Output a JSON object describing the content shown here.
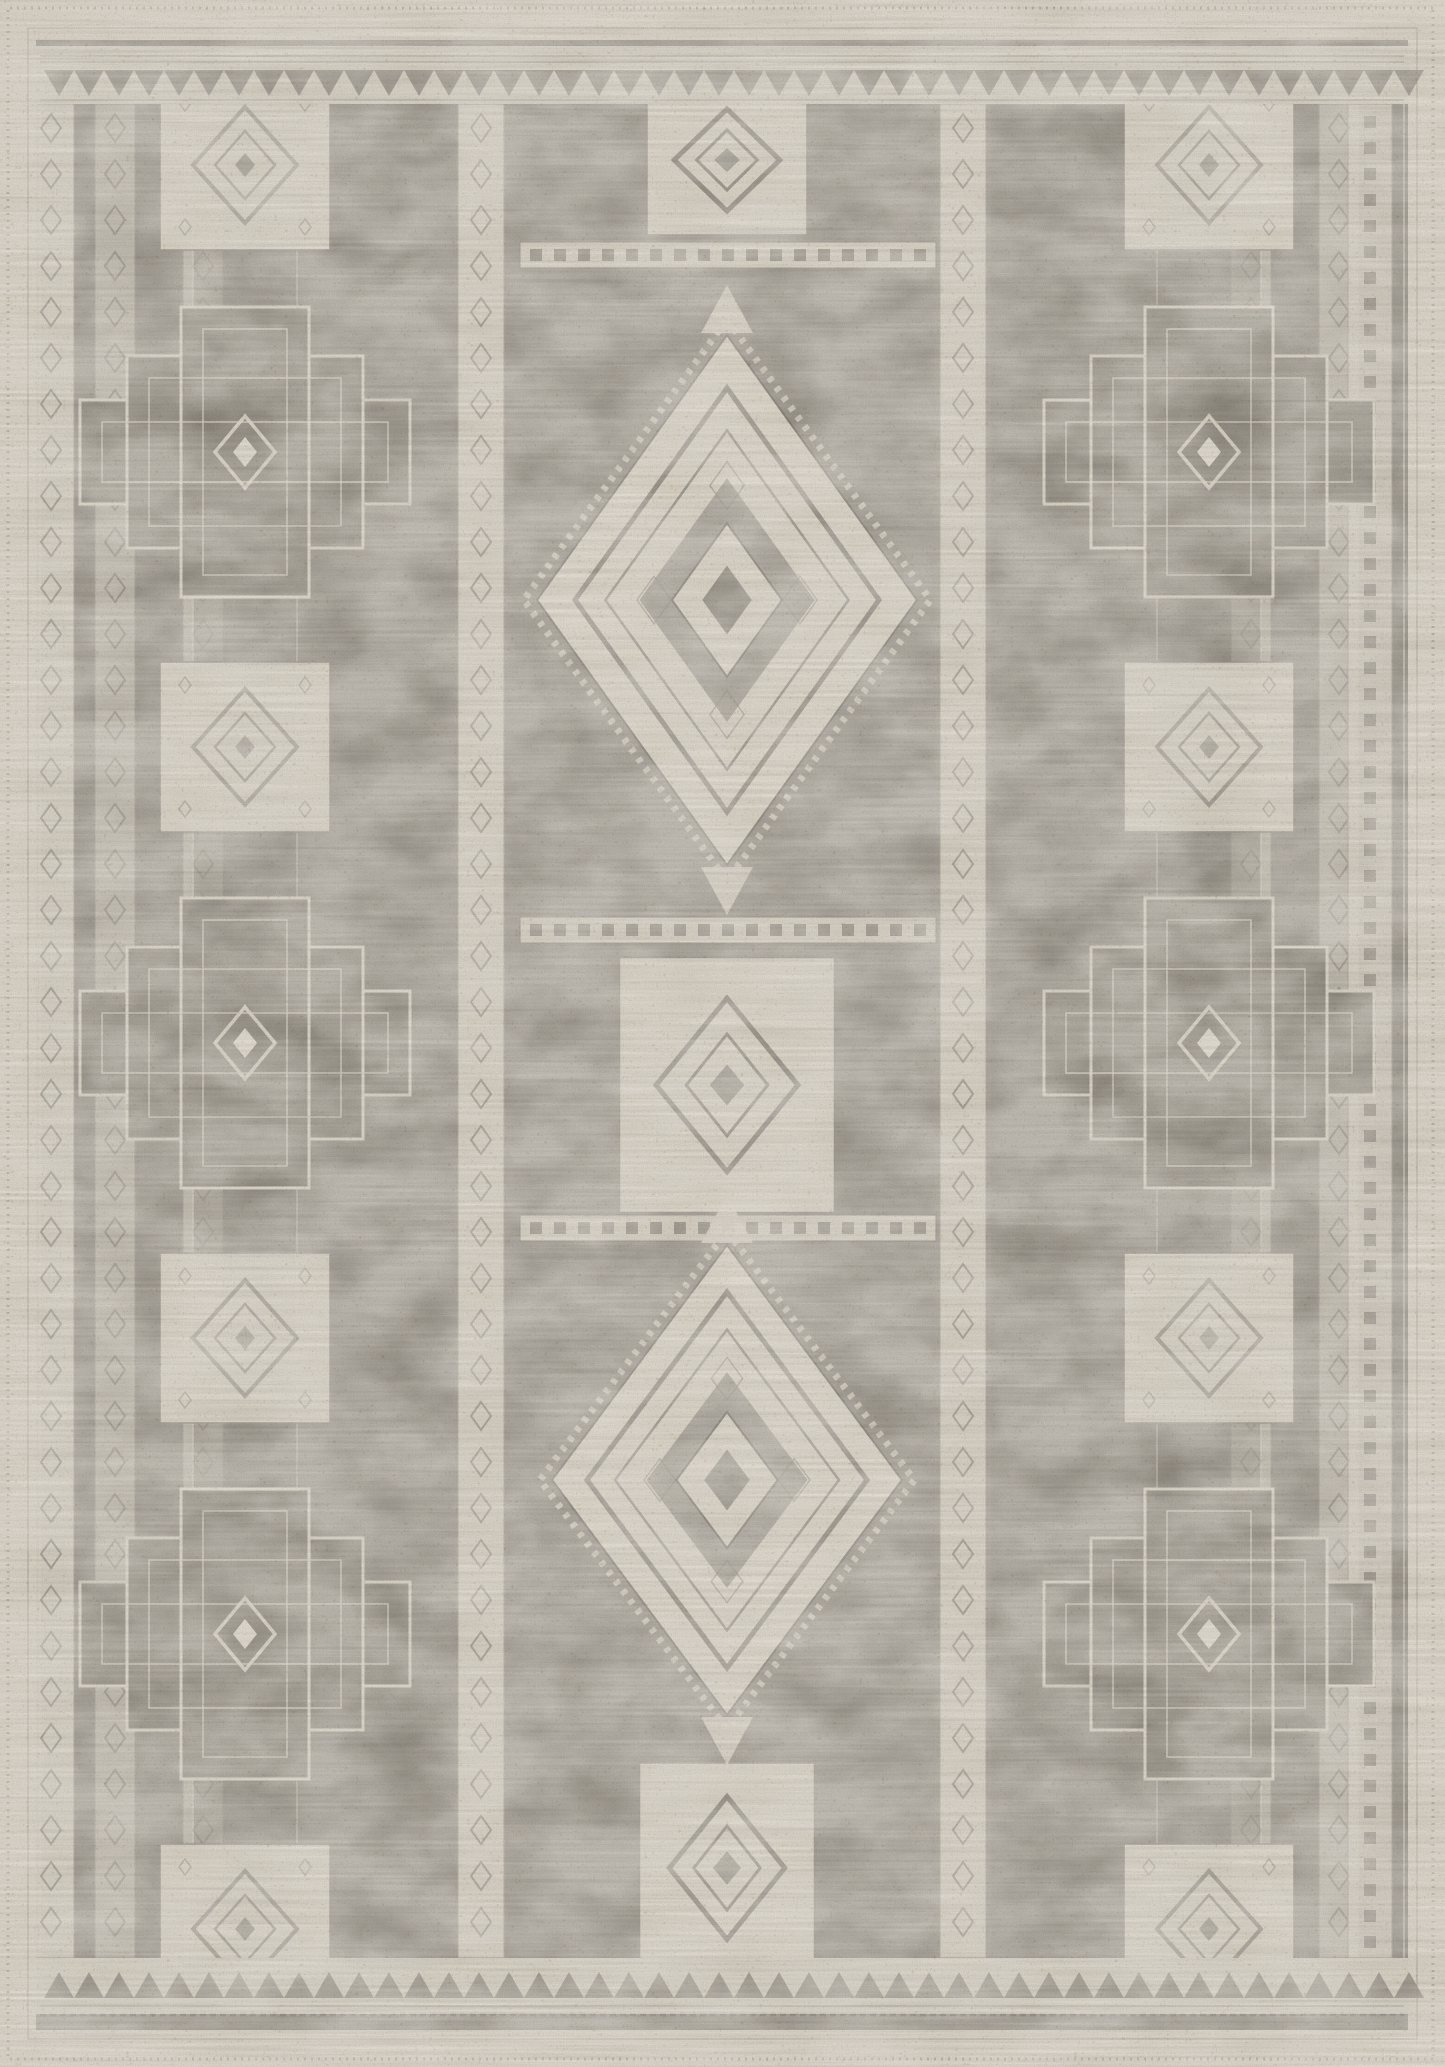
{
  "image": {
    "kind": "product-photo",
    "subject": "distressed gray and cream tribal geometric area rug, flat overhead view",
    "width": 1445,
    "height": 2067
  },
  "palette": {
    "margin_cream": "#ebe4d7",
    "field_gray": "#a9a49b",
    "zone_mid": "#a39e95",
    "zone_dark": "#9b968d",
    "zone_col": "#a6a198",
    "motif_cream": "#ede7da",
    "bright_cream": "#f3eee3",
    "outline_gray": "#8c877e",
    "mid_gray": "#989389",
    "dark_gray": "#6e6960",
    "tan_speckle": "#b98e60",
    "line_soft": "#b6b0a5",
    "stitch": "#a59e92"
  },
  "layout": {
    "canvas": {
      "w": 1445,
      "h": 2067
    },
    "stitch_inset": 8,
    "line_inset": 28,
    "field": {
      "x": 36,
      "y": 40,
      "w": 1372,
      "h": 1990
    },
    "content": {
      "x": 36,
      "y": 104,
      "w": 1372,
      "h": 1854
    },
    "guards": {
      "top_band": {
        "y": 46,
        "h": 58
      },
      "bottom_band": {
        "y": 1958,
        "h": 56
      },
      "tri_top": {
        "y_base": 70,
        "y_apex": 96,
        "x0": 44,
        "x1": 1400,
        "step": 30
      },
      "tri_bottom": {
        "y_base": 1998,
        "y_apex": 1972,
        "x0": 44,
        "x1": 1400,
        "step": 30
      },
      "top_lines": [
        56,
        62,
        100
      ],
      "bottom_lines": [
        2006,
        2022
      ],
      "bottom_dash_y": 2015
    },
    "zones": [
      {
        "x": 36,
        "w": 34,
        "fill": "zone_dark"
      },
      {
        "x": 70,
        "w": 388,
        "fill": "zone_mid"
      },
      {
        "x": 505,
        "w": 430,
        "fill": "zone_col"
      },
      {
        "x": 991,
        "w": 356,
        "fill": "zone_mid"
      },
      {
        "x": 1347,
        "w": 61,
        "fill": "zone_dark"
      }
    ],
    "under_chains": [
      115,
      203,
      1251,
      1339
    ],
    "chains": [
      51,
      481,
      963
    ],
    "chain_width": 46,
    "under_chain_width": 40,
    "chain_step": 46,
    "meander_col_x": 1370,
    "meander_col_w": 44,
    "side_axes": [
      245,
      1209
    ],
    "cross_cys": [
      452,
      1043,
      1634
    ],
    "cross_rects": [
      [
        330,
        104
      ],
      [
        236,
        192
      ],
      [
        128,
        290
      ]
    ],
    "panel_cys": [
      165,
      747,
      1338,
      1929
    ],
    "between_panel": {
      "w": 170,
      "h": 170
    },
    "central": {
      "cx": 727,
      "meander_ys": [
        255,
        930,
        1228
      ],
      "meander": {
        "x": 520,
        "w": 416,
        "h": 26
      },
      "panels": [
        {
          "cy": 160,
          "w": 160,
          "h": 150
        },
        {
          "cy": 1085,
          "w": 215,
          "h": 255
        },
        {
          "cy": 1868,
          "w": 175,
          "h": 210
        }
      ],
      "medallions": [
        {
          "cy": 600,
          "rx": 190,
          "ry": 265
        },
        {
          "cy": 1480,
          "rx": 175,
          "ry": 235
        }
      ]
    }
  }
}
